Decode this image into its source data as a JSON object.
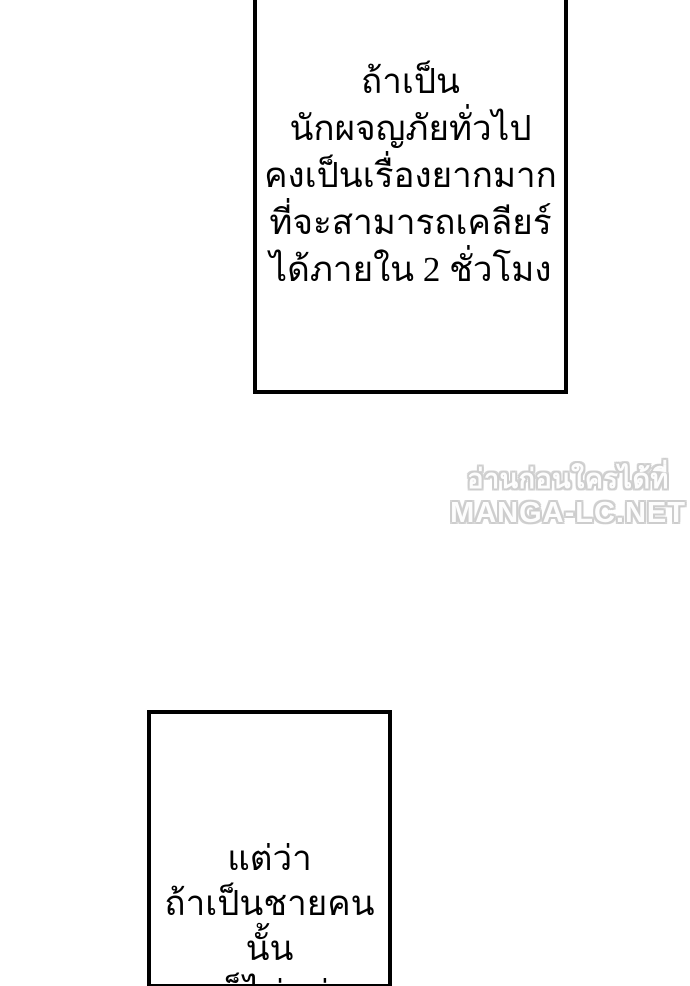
{
  "page": {
    "background_color": "#ffffff",
    "panel_border_color": "#000000",
    "caption_text_color": "#000000"
  },
  "top_panel": {
    "lines": [
      "ถ้าเป็น",
      "นักผจญภัยทั่วไป",
      "คงเป็นเรื่องยากมาก",
      "ที่จะสามารถเคลียร์",
      "ได้ภายใน 2 ชั่วโมง"
    ]
  },
  "watermark": {
    "line1": "อ่านก่อนใครได้ที่",
    "line2": "MANGA-LC.NET",
    "fill_color": "#fdfdfd",
    "outline_color": "#cdcdcd"
  },
  "bottom_panel": {
    "lines": [
      "แต่ว่า",
      "ถ้าเป็นชายคนนั้น",
      "ละก็ไม่แน่..."
    ]
  }
}
